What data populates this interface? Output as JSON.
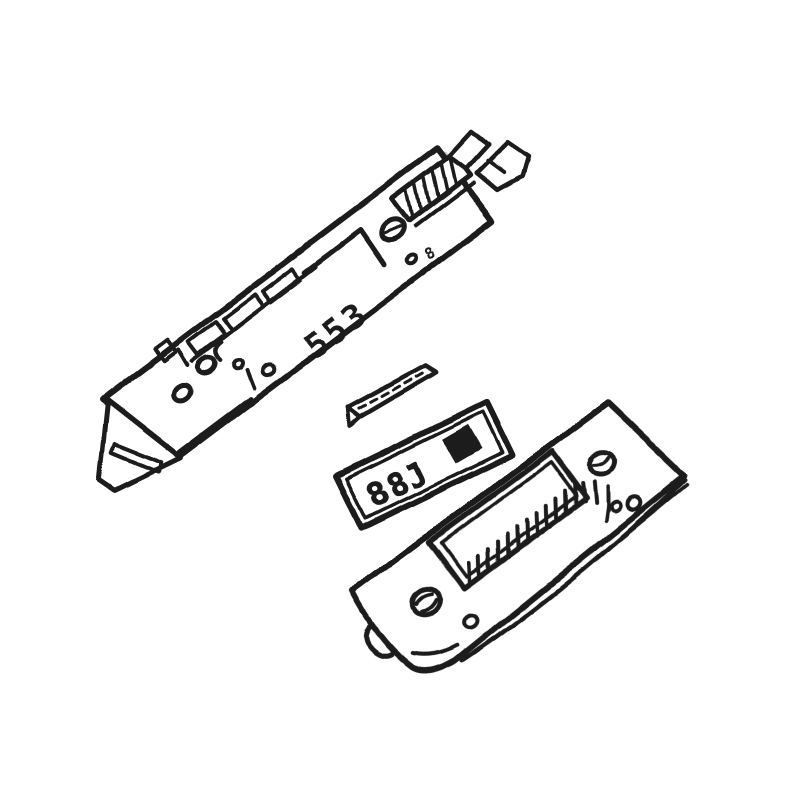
{
  "meta": {
    "background": "#ffffff",
    "ink": "#1b1b1b",
    "highlight": "#c7c7c7"
  },
  "figure": {
    "type": "exploded-parts-line-drawing",
    "parts": [
      {
        "id": "main-board",
        "desc": "long angled board with mounting flap, holes, rail and edge connector"
      },
      {
        "id": "spacer-strip",
        "desc": "thin spacer strip with dashed center line"
      },
      {
        "id": "display-label",
        "desc": "label plate showing display characters and a solid block"
      },
      {
        "id": "front-cover",
        "desc": "front cover with rectangular window, two screws and foot tab"
      }
    ],
    "markings": {
      "display_text": "88J",
      "board_marking": "553",
      "board_small_mark": "8"
    }
  }
}
